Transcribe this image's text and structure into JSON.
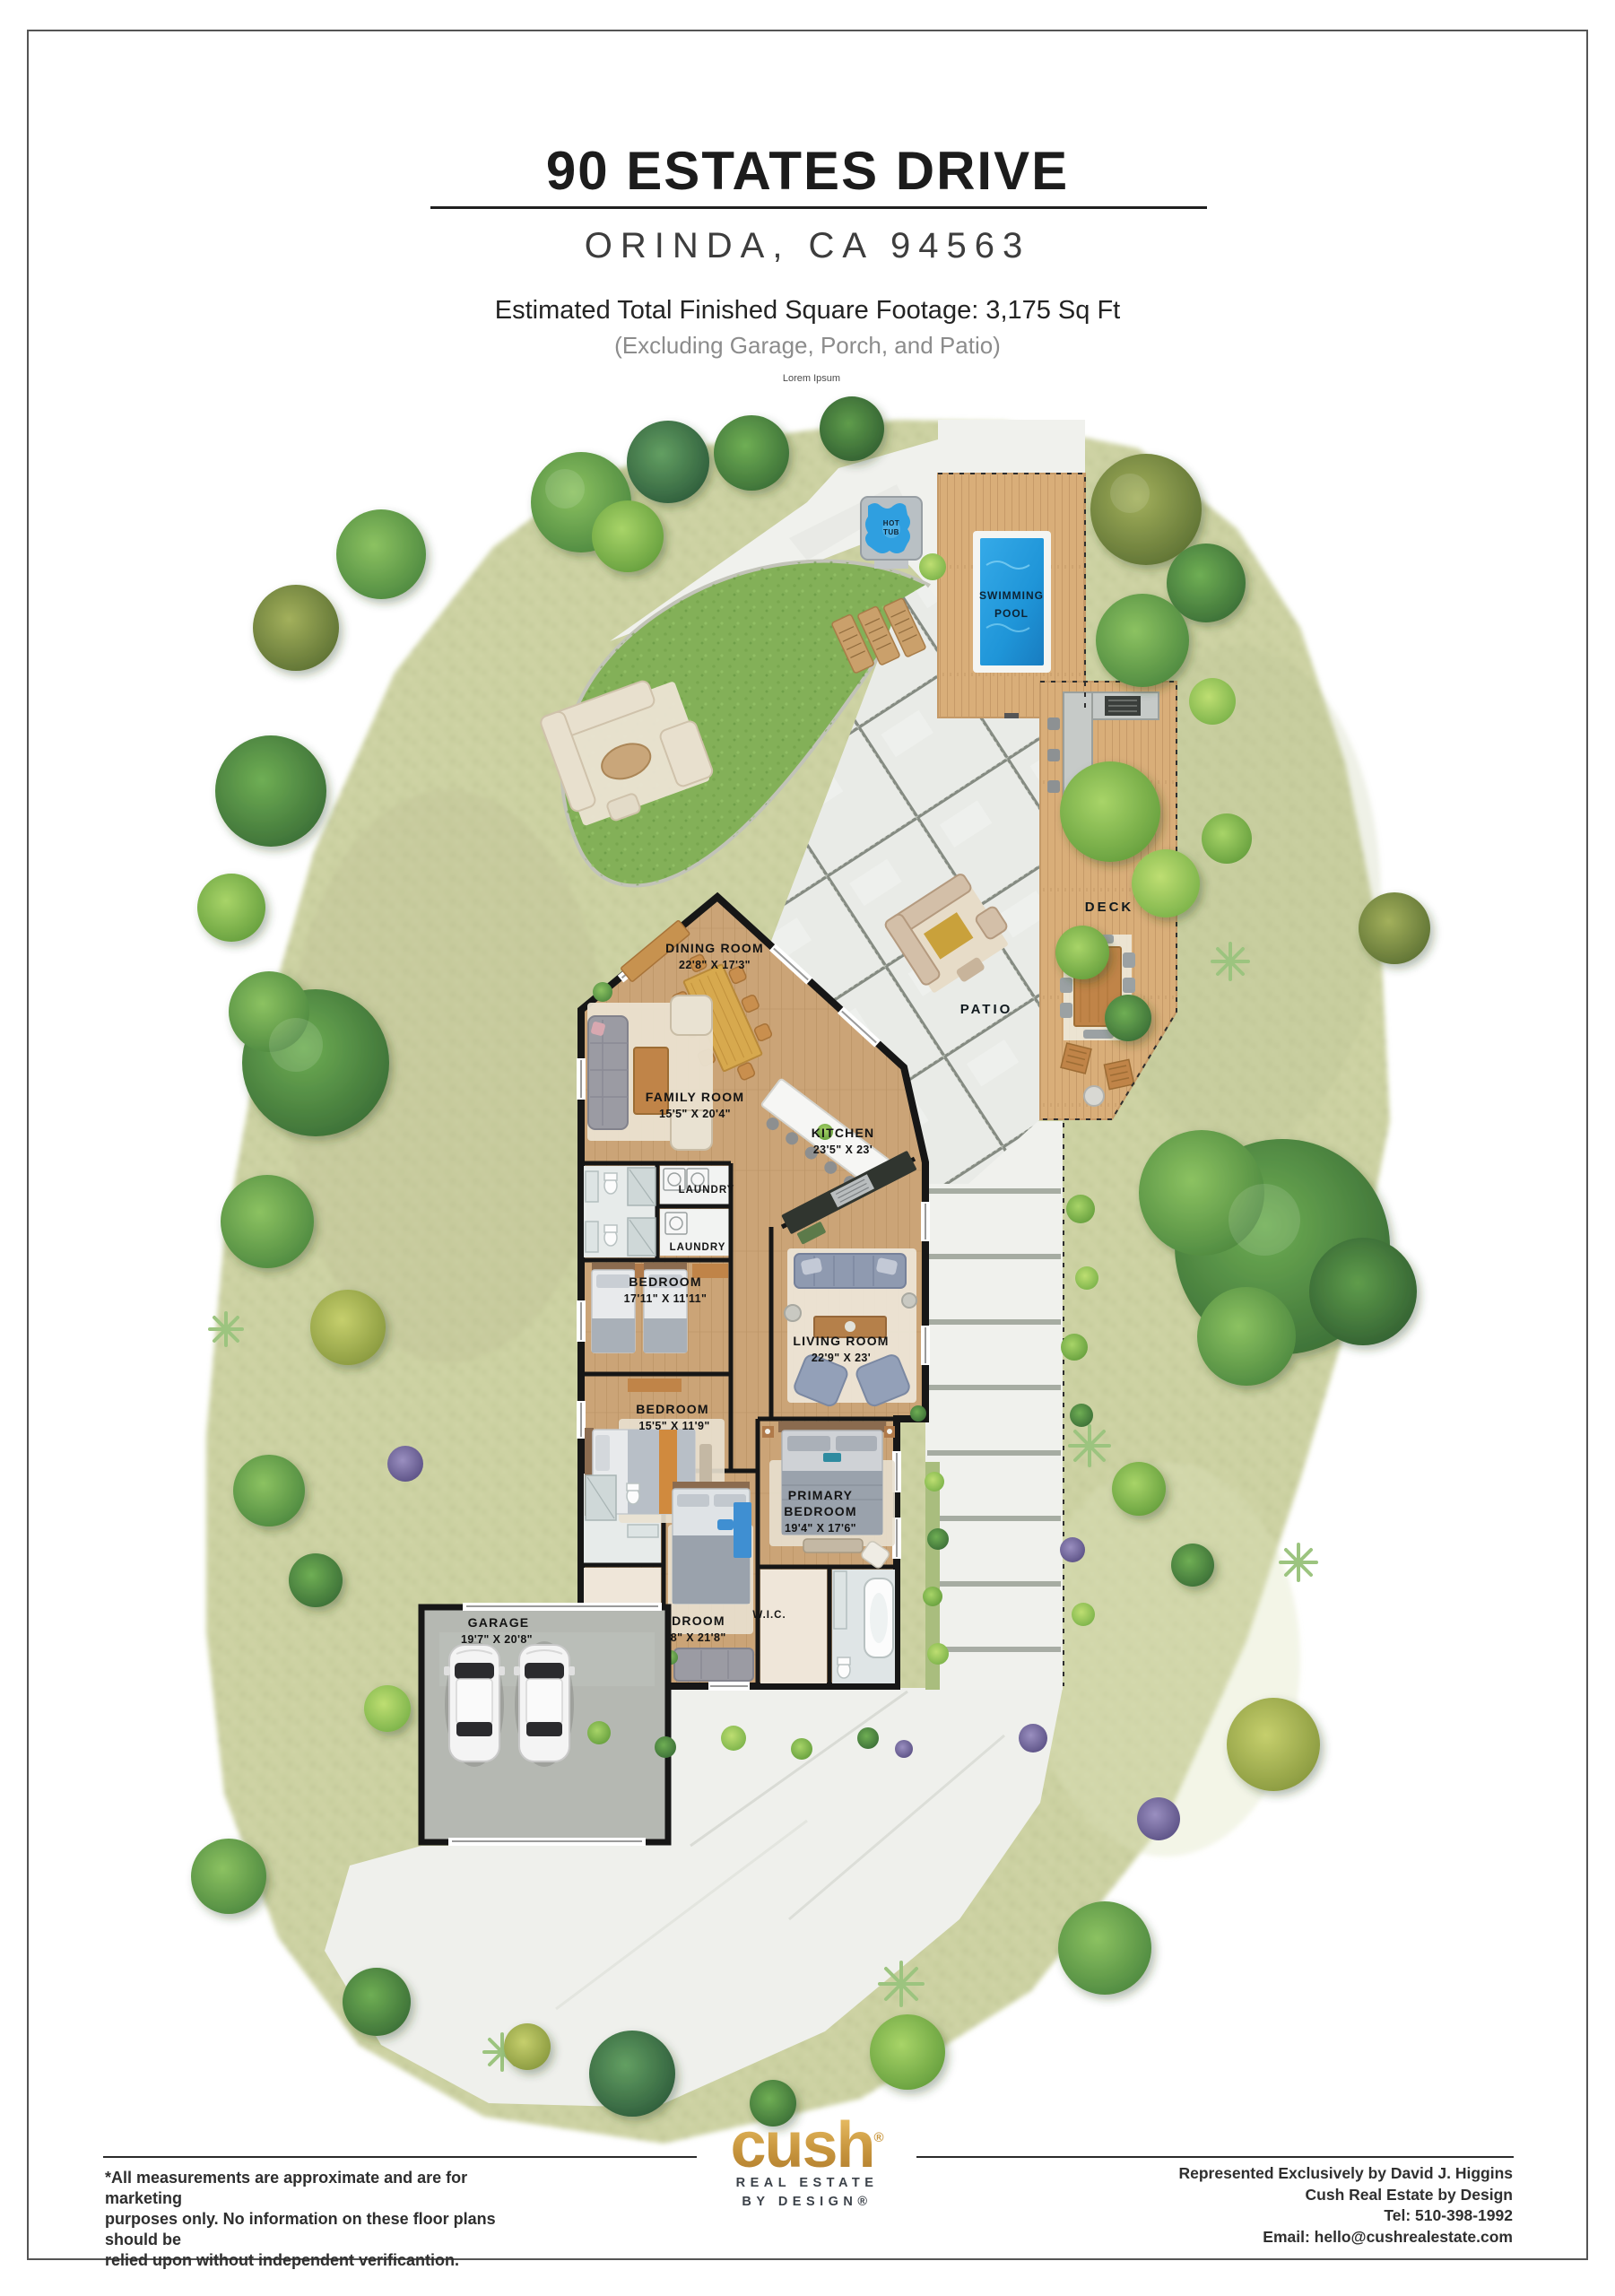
{
  "colors": {
    "gold": "#c9973f",
    "gold_light": "#ecc473",
    "wall": "#161616",
    "pool_water": "#1f95d8",
    "lawn": "#83b058",
    "scrub": "#ccd1a2",
    "wood_deck": "#d9ae79",
    "house_floor": "#cba477",
    "concrete": "#f0f1ed",
    "garage_slab": "#b5b8b2"
  },
  "header": {
    "title": "90 ESTATES DRIVE",
    "subtitle": "ORINDA, CA 94563",
    "sqft_line": "Estimated Total Finished Square Footage: 3,175 Sq Ft",
    "sqft_note": "(Excluding Garage, Porch, and Patio)",
    "micro_note": "Lorem Ipsum"
  },
  "plan": {
    "outdoor": {
      "pool_line1": "SWIMMING",
      "pool_line2": "POOL",
      "hot_tub_line1": "HOT",
      "hot_tub_line2": "TUB",
      "deck": "DECK",
      "patio": "PATIO"
    },
    "rooms": [
      {
        "name_lines": [
          "DINING ROOM"
        ],
        "dims": "22'8\" X 17'3\""
      },
      {
        "name_lines": [
          "FAMILY ROOM"
        ],
        "dims": "15'5\" X 20'4\""
      },
      {
        "name_lines": [
          "KITCHEN"
        ],
        "dims": "23'5\" X 23'"
      },
      {
        "name_lines": [
          "LAUNDRY"
        ],
        "dims": ""
      },
      {
        "name_lines": [
          "LAUNDRY"
        ],
        "dims": ""
      },
      {
        "name_lines": [
          "BEDROOM"
        ],
        "dims": "17'11\" X 11'11\""
      },
      {
        "name_lines": [
          "LIVING ROOM"
        ],
        "dims": "22'9\" X 23'"
      },
      {
        "name_lines": [
          "BEDROOM"
        ],
        "dims": "15'5\" X 11'9\""
      },
      {
        "name_lines": [
          "PRIMARY",
          "BEDROOM"
        ],
        "dims": "19'4\" X 17'6\""
      },
      {
        "name_lines": [
          "BEDROOM"
        ],
        "dims": "11'8\" X 21'8\""
      },
      {
        "name_lines": [
          "W.I.C."
        ],
        "dims": ""
      },
      {
        "name_lines": [
          "W.I.C."
        ],
        "dims": ""
      },
      {
        "name_lines": [
          "GARAGE"
        ],
        "dims": "19'7\" X 20'8\""
      }
    ]
  },
  "footer": {
    "disclaimer_lines": [
      "*All measurements are approximate and are for marketing",
      "purposes only. No information on these floor plans should be",
      "relied upon without independent verificantion."
    ],
    "brand": {
      "wordmark": "cush",
      "registered": "®",
      "tagline_line1": "REAL ESTATE",
      "tagline_line2": "BY DESIGN®"
    },
    "contact_lines": [
      "Represented Exclusively by David J. Higgins",
      "Cush Real Estate by Design",
      "Tel: 510-398-1992",
      "Email: hello@cushrealestate.com"
    ]
  }
}
